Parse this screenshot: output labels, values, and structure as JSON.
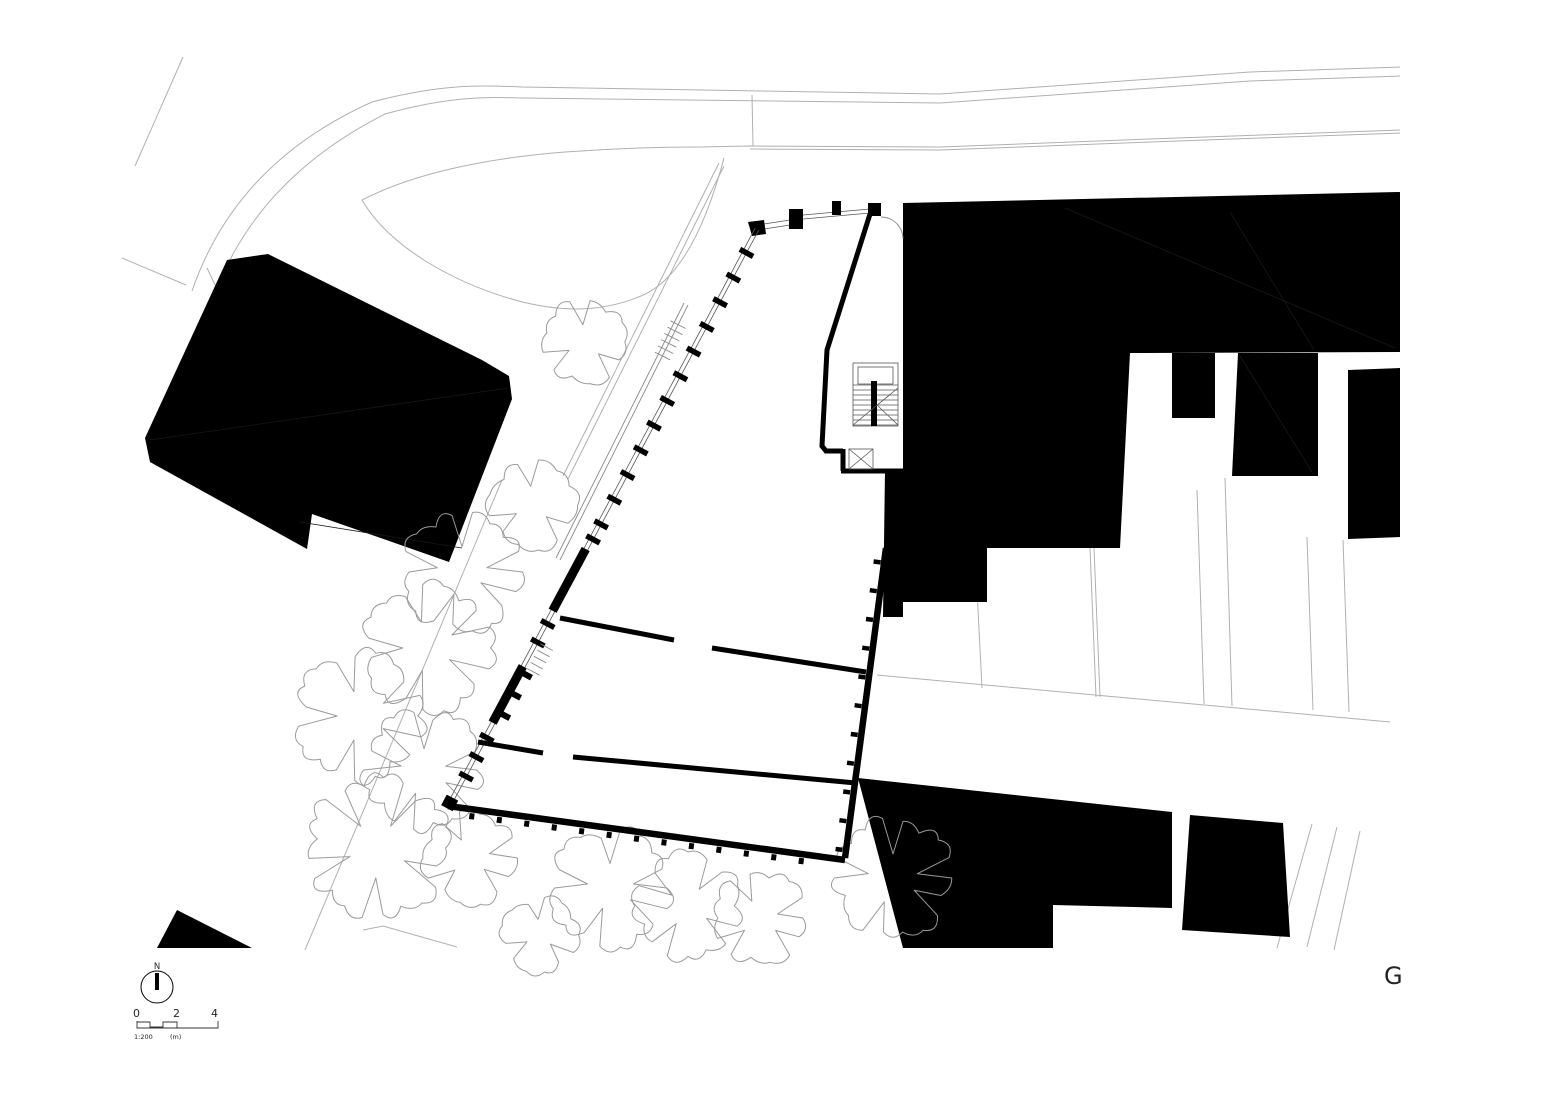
{
  "sheet": {
    "label": "G"
  },
  "north": {
    "label": "N"
  },
  "scale_bar": {
    "marks": [
      "0",
      "2",
      "4"
    ],
    "ratio": "1:200",
    "unit": "(m)"
  },
  "colors": {
    "ink": "#000000",
    "paper": "#ffffff",
    "site_line": "#b0b0b0",
    "tree_line": "#9a9a9a",
    "detail_line": "#888888",
    "text": "#222222"
  }
}
